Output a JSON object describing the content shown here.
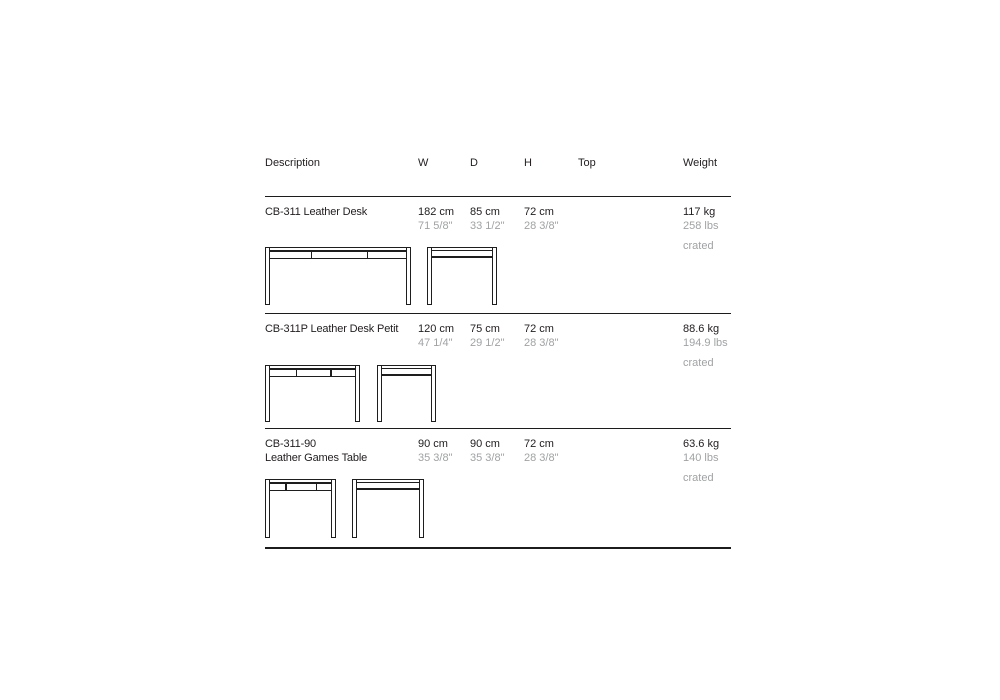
{
  "header": {
    "description": "Description",
    "w": "W",
    "d": "D",
    "h": "H",
    "top": "Top",
    "weight": "Weight"
  },
  "rows": [
    {
      "name_line1": "CB-311 Leather Desk",
      "name_line2": "",
      "w_cm": "182 cm",
      "w_in": "71 5/8\"",
      "d_cm": "85 cm",
      "d_in": "33 1/2\"",
      "h_cm": "72 cm",
      "h_in": "28 3/8\"",
      "weight_kg": "117 kg",
      "weight_lbs": "258 lbs",
      "shipping": "crated"
    },
    {
      "name_line1": "CB-311P Leather Desk Petit",
      "name_line2": "",
      "w_cm": "120 cm",
      "w_in": "47 1/4\"",
      "d_cm": "75 cm",
      "d_in": "29 1/2\"",
      "h_cm": "72 cm",
      "h_in": "28 3/8\"",
      "weight_kg": "88.6 kg",
      "weight_lbs": "194.9 lbs",
      "shipping": "crated"
    },
    {
      "name_line1": "CB-311-90",
      "name_line2": "Leather Games Table",
      "w_cm": "90 cm",
      "w_in": "35 3/8\"",
      "d_cm": "90 cm",
      "d_in": "35 3/8\"",
      "h_cm": "72 cm",
      "h_in": "28 3/8\"",
      "weight_kg": "63.6 kg",
      "weight_lbs": "140 lbs",
      "shipping": "crated"
    }
  ],
  "colors": {
    "text_primary": "#242021",
    "text_secondary": "#a0a2a4",
    "rule": "#1c1c1c",
    "drawing_line": "#1e1e1e",
    "background": "#ffffff"
  }
}
